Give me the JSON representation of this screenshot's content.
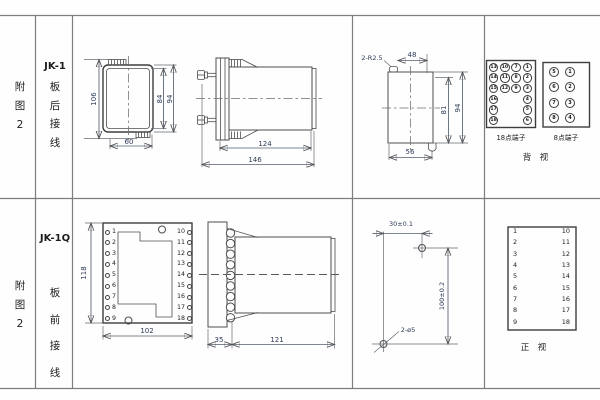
{
  "sheet": {
    "row1": {
      "fig_label": "附\n图\n2",
      "model": "JK-1",
      "wiring": "板\n后\n接\n线",
      "front": {
        "dim_height": "106",
        "dim_inner_height": "84",
        "dim_outer_height": "94",
        "dim_width": "60"
      },
      "side": {
        "dim_body": "124",
        "dim_total": "146"
      },
      "cutout": {
        "corner_note": "2-R2.5",
        "dim_top": "48",
        "dim_inner": "81",
        "dim_outer": "94",
        "dim_bottom": "56"
      },
      "terminals18": {
        "caption": "18点端子",
        "cells": [
          "13",
          "10",
          "7",
          "1",
          "14",
          "11",
          "8",
          "2",
          "15",
          "12",
          "9",
          "3",
          "16",
          "",
          "",
          "4",
          "17",
          "",
          "",
          "5",
          "18",
          "",
          "",
          "6"
        ]
      },
      "terminals8": {
        "caption": "8点端子",
        "cells": [
          "5",
          "1",
          "6",
          "2",
          "7",
          "3",
          "8",
          "4"
        ]
      },
      "view_label": "背  视"
    },
    "row2": {
      "fig_label": "附\n图\n2",
      "model": "JK-1Q",
      "wiring": "板\n前\n接\n线",
      "front": {
        "dim_height": "118",
        "dim_width": "102",
        "left_terminals": [
          "1",
          "2",
          "3",
          "4",
          "5",
          "6",
          "7",
          "8",
          "9"
        ],
        "right_terminals": [
          "10",
          "11",
          "12",
          "13",
          "14",
          "15",
          "16",
          "17",
          "18"
        ]
      },
      "side": {
        "dim_flange": "35",
        "dim_body": "121"
      },
      "drill": {
        "dim_horizontal": "30±0.1",
        "dim_vertical": "100±0.2",
        "hole_note": "2-ø5"
      },
      "table": {
        "left": [
          "1",
          "2",
          "3",
          "4",
          "5",
          "6",
          "7",
          "8",
          "9"
        ],
        "right": [
          "10",
          "11",
          "12",
          "13",
          "14",
          "15",
          "16",
          "17",
          "18"
        ]
      },
      "view_label": "正  视"
    }
  }
}
